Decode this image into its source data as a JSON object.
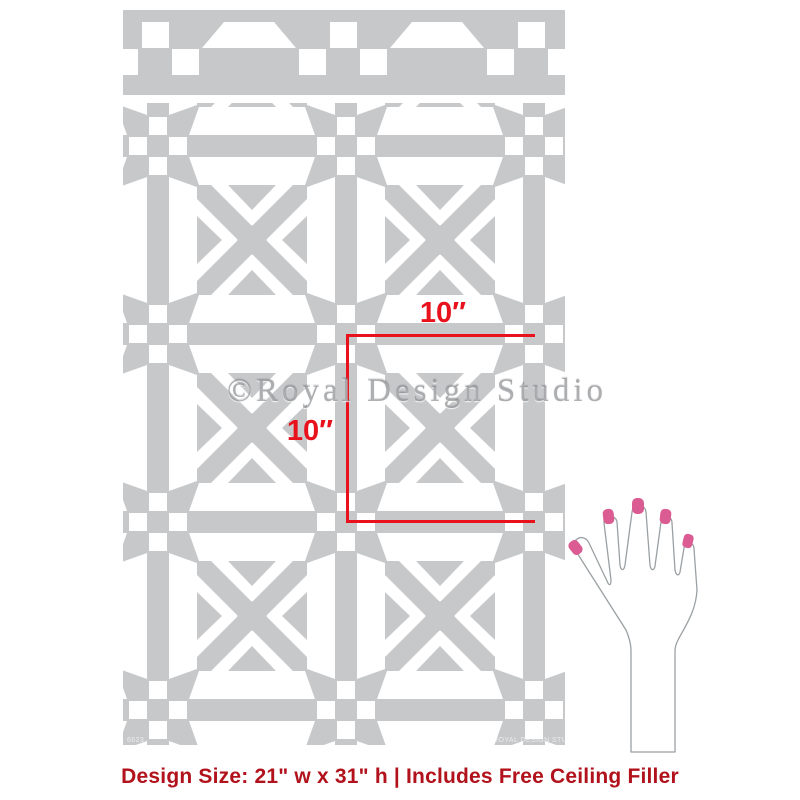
{
  "product": {
    "type": "wall stencil preview",
    "caption": "Design Size: 21\" w x 31\" h | Includes Free Ceiling Filler"
  },
  "measurements": {
    "width_label": "10″",
    "height_label": "10″"
  },
  "watermark": {
    "text": "©Royal Design Studio"
  },
  "stencil": {
    "sheet_code": "6623",
    "copyright": "©2023 ROYAL DESIGN STUDIO"
  },
  "colors": {
    "stencil_gray": "#c6c8ca",
    "measure_red": "#e8111c",
    "caption_red": "#b1121b",
    "nail_pink": "#da5c92",
    "hand_outline": "#9aa0a3"
  }
}
